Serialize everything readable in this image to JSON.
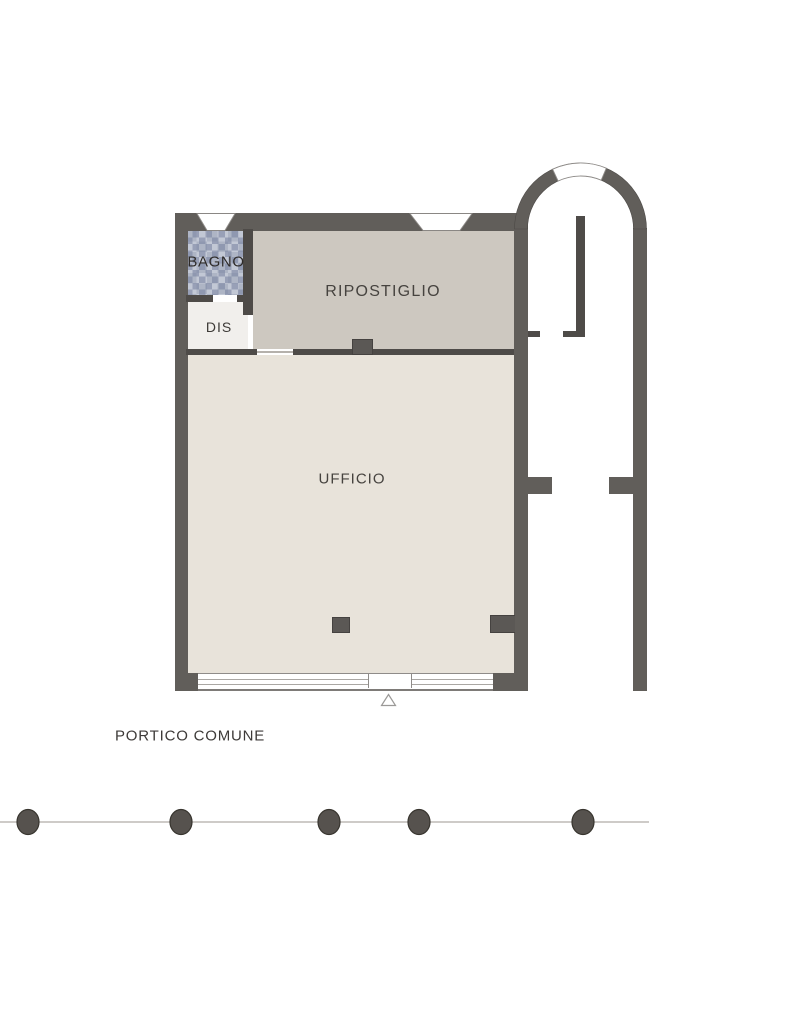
{
  "plan": {
    "type": "floor-plan",
    "rooms": {
      "bagno": {
        "label": "BAGNO"
      },
      "dis": {
        "label": "DIS"
      },
      "ripostiglio": {
        "label": "RIPOSTIGLIO"
      },
      "ufficio": {
        "label": "UFFICIO"
      }
    },
    "outdoor": {
      "portico_label": "PORTICO COMUNE"
    },
    "markers": {
      "entrance_triangle": "triangle-outline",
      "portico_columns_count": 5,
      "top_wall_windows_count": 2,
      "arched_element": "round-arch-with-window-at-apex"
    },
    "colors": {
      "wall": "#615e5a",
      "interior_wall": "#4e4b48",
      "floor_ufficio": "#e8e3da",
      "floor_ripostiglio": "#cdc8c0",
      "floor_dis": "#f1efec",
      "bagno_tile": "#aeb5c5",
      "label_text": "#46433f",
      "background": "#ffffff"
    }
  }
}
